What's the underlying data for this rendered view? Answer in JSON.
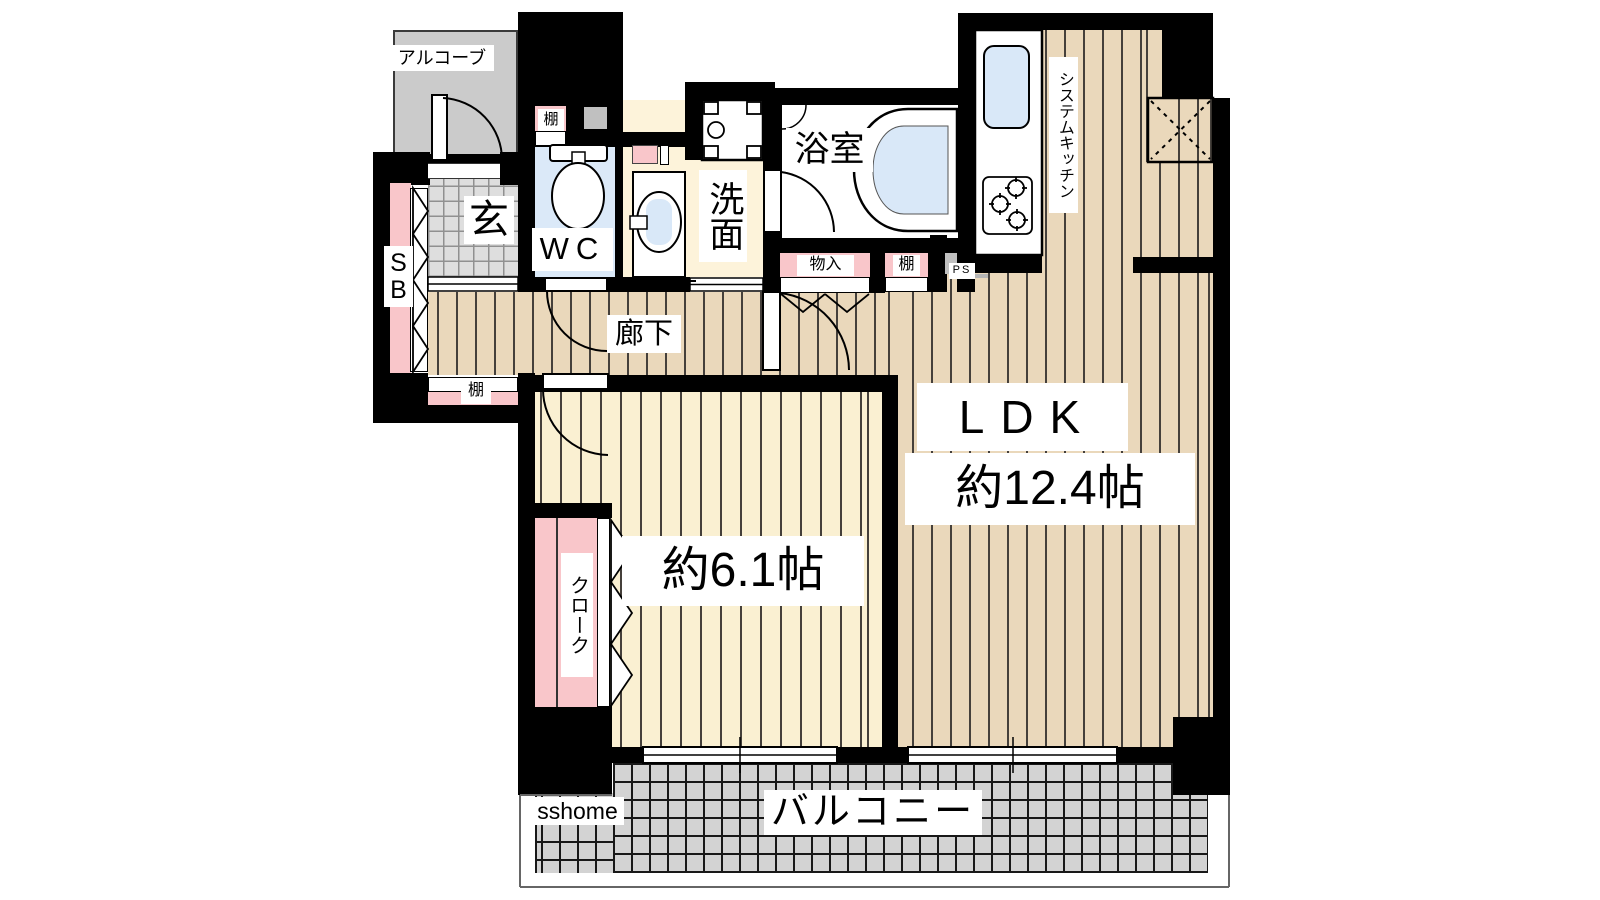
{
  "floorplan": {
    "labels": {
      "alcove": "アルコーブ",
      "shelf_top": "棚",
      "entrance": "玄",
      "shoe_box": "SB",
      "wc": "WC",
      "washroom": "洗面",
      "bathroom": "浴室",
      "system_kitchen": "システムキッチン",
      "corridor": "廊下",
      "storage": "物入",
      "shelf_kitchen": "棚",
      "pipe_space": "PS",
      "ldk": "LDK",
      "ldk_size": "約12.4帖",
      "bedroom_size": "約6.1帖",
      "cloak": "クローク",
      "shelf_hall": "棚",
      "balcony": "バルコニー",
      "watermark": "sshome"
    },
    "colors": {
      "wall": "#000000",
      "wood_floor": "#ead8bb",
      "bedroom_floor": "#faf0d2",
      "washroom_floor": "#fdf3da",
      "wc_floor": "#dbe9f8",
      "entrance_tile": "#dedede",
      "balcony_tile": "#d3d3d3",
      "alcove_gray": "#cbcbcb",
      "accent_pink": "#f9c6ca",
      "water_blue": "#d9e8f8"
    }
  }
}
